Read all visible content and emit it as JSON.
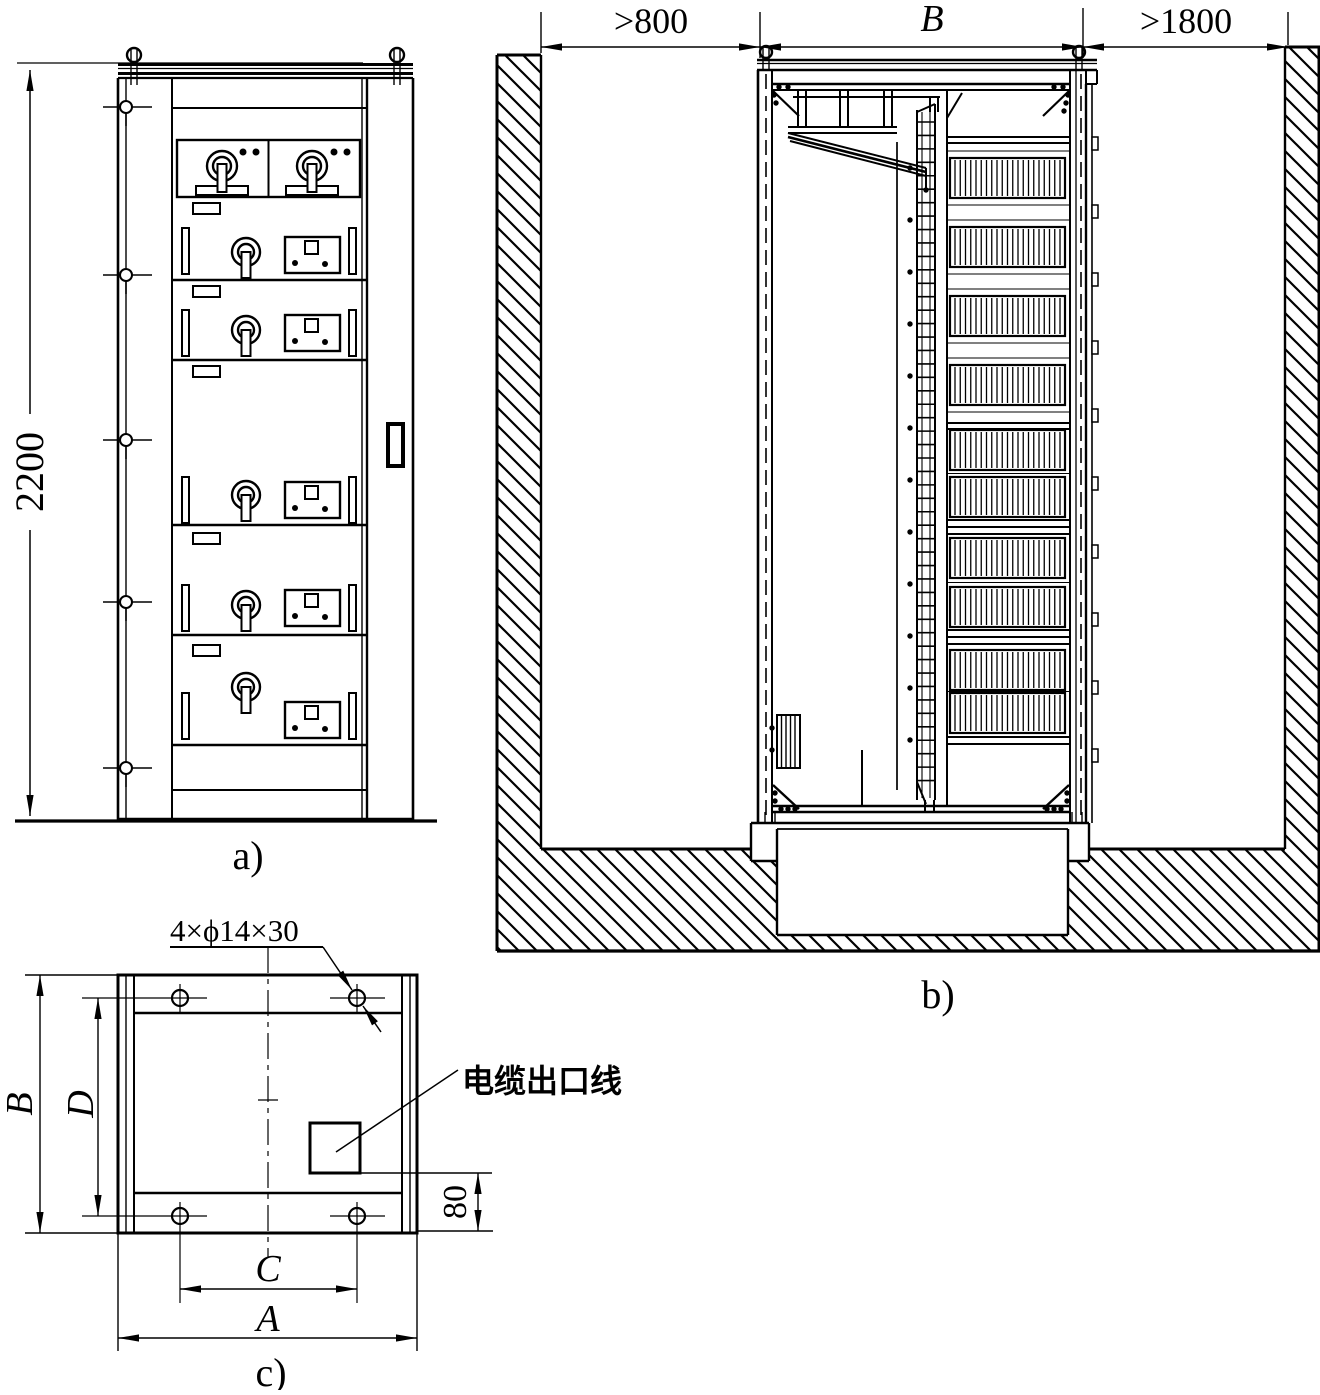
{
  "views": {
    "front": {
      "caption": "a)",
      "height_dim": "2200"
    },
    "section": {
      "caption": "b)",
      "left_clearance_dim": ">800",
      "cabinet_width_dim": "B",
      "right_clearance_dim": ">1800"
    },
    "plan": {
      "caption": "c)",
      "holes_note": "4×ϕ14×30",
      "cable_outlet_label": "电缆出口线",
      "width_dim": "A",
      "hole_span_width_dim": "C",
      "depth_dim": "B",
      "hole_span_depth_dim": "D",
      "outlet_offset_dim": "80"
    }
  },
  "colors": {
    "ink": "#000000",
    "paper": "#ffffff"
  }
}
